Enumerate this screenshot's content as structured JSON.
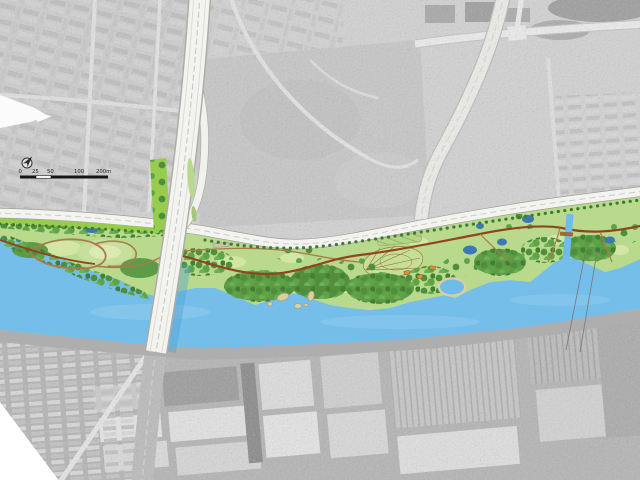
{
  "scale_bar": {
    "labels": [
      "0",
      "25",
      "50",
      "100",
      "200m"
    ]
  },
  "north_arrow": {
    "icon": "north-arrow-icon"
  },
  "palette": {
    "aerial_base": "#D2D2D2",
    "industrial_base": "#B4B4B4",
    "river": "#74BEE9",
    "pond": "#3B78B4",
    "lagoon": "#6FBCE9",
    "park_lawn": "#B9D98C",
    "meadow": "#D3E6A6",
    "tree_dark": "#3E7C31",
    "tree_mid": "#579A40",
    "tree_light": "#79B356",
    "bright_verge": "#97CC4F",
    "path_main": "#8F4520",
    "path_minor": "#A97B4A",
    "road_surface": "#F3F3EF",
    "road_casing": "#A0A09A",
    "bridge_deck": "#F3F3EF",
    "embankment": "#AEAEAE",
    "island": "#D8CFA4",
    "building_roof": "#D8923F",
    "scalebar_ink": "#161616"
  }
}
